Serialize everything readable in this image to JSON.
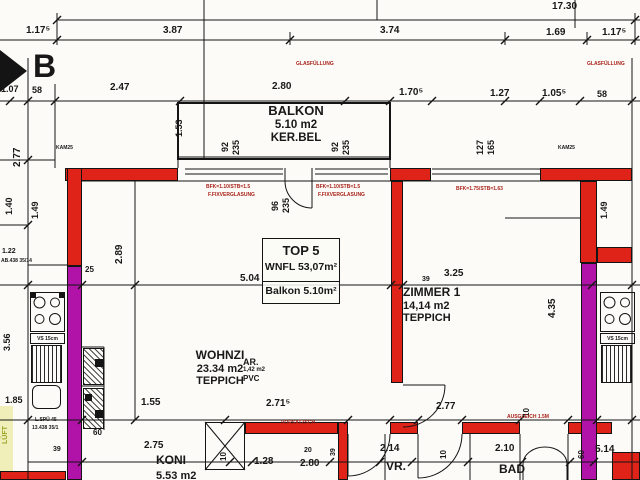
{
  "colors": {
    "wall_load_bearing": "#df2318",
    "wall_party": "#b112a7",
    "linework": "#141414",
    "note_red": "#a8211a",
    "highlight": "#e6e588",
    "paper": "#fcfbf7"
  },
  "section_marker": {
    "label": "B"
  },
  "unit_box": {
    "line1": "TOP 5",
    "line2": "WNFL 53,07m²",
    "line3": "Balkon 5.10m²"
  },
  "rooms": {
    "balkon": {
      "name": "BALKON",
      "area": "5.10 m2",
      "floor": "KER.BEL"
    },
    "wohnzimmer": {
      "name": "WOHNZI",
      "area": "23.34 m2",
      "floor": "TEPPICH"
    },
    "zimmer1": {
      "name": "ZIMMER 1",
      "area": "14,14 m2",
      "floor": "TEPPICH"
    },
    "abstellraum": {
      "name": "AR.",
      "area": "1,42 m2",
      "floor": "PVC"
    },
    "kochnische": {
      "name": "KONI",
      "area": "5.53 m2"
    },
    "vorraum": {
      "name": "VR."
    },
    "bad": {
      "name": "BAD"
    }
  },
  "fixtures": {
    "vs_label": "VS 15cm"
  },
  "annotations": [
    {
      "t": "17.30",
      "x": 552,
      "y": 2,
      "s": 10
    },
    {
      "t": "1.17⁵",
      "x": 26,
      "y": 26,
      "s": 10
    },
    {
      "t": "3.87",
      "x": 163,
      "y": 26,
      "s": 10
    },
    {
      "t": "3.74",
      "x": 380,
      "y": 26,
      "s": 10
    },
    {
      "t": "1.69",
      "x": 546,
      "y": 28,
      "s": 10
    },
    {
      "t": "1.17⁵",
      "x": 602,
      "y": 28,
      "s": 10
    },
    {
      "t": "1.07",
      "x": 1,
      "y": 85,
      "s": 9
    },
    {
      "t": "58",
      "x": 32,
      "y": 86,
      "s": 9
    },
    {
      "t": "2.47",
      "x": 110,
      "y": 83,
      "s": 10
    },
    {
      "t": "2.80",
      "x": 272,
      "y": 82,
      "s": 10
    },
    {
      "t": "1.70⁵",
      "x": 399,
      "y": 88,
      "s": 10
    },
    {
      "t": "1.27",
      "x": 490,
      "y": 89,
      "s": 10
    },
    {
      "t": "1.05⁵",
      "x": 542,
      "y": 89,
      "s": 10
    },
    {
      "t": "58",
      "x": 597,
      "y": 90,
      "s": 9
    },
    {
      "t": "GLASFÜLLUNG",
      "x": 296,
      "y": 62,
      "s": 5,
      "c": "red"
    },
    {
      "t": "GLASFÜLLUNG",
      "x": 587,
      "y": 62,
      "s": 5,
      "c": "red"
    },
    {
      "t": "KAM25",
      "x": 56,
      "y": 146,
      "s": 5
    },
    {
      "t": "KAM25",
      "x": 558,
      "y": 146,
      "s": 5
    },
    {
      "t": "BFK=1.10/STB=1.5",
      "x": 206,
      "y": 185,
      "s": 5,
      "c": "red"
    },
    {
      "t": "F.FIXVERGLASUNG",
      "x": 208,
      "y": 193,
      "s": 5,
      "c": "red"
    },
    {
      "t": "BFK=1.10/STB=1.5",
      "x": 316,
      "y": 185,
      "s": 5,
      "c": "red"
    },
    {
      "t": "F.FIXVERGLASUNG",
      "x": 318,
      "y": 193,
      "s": 5,
      "c": "red"
    },
    {
      "t": "BFK=1.75/STB=1.63",
      "x": 456,
      "y": 187,
      "s": 5,
      "c": "red"
    },
    {
      "t": "92",
      "x": 221,
      "y": 152,
      "r": 1,
      "s": 9
    },
    {
      "t": "235",
      "x": 232,
      "y": 155,
      "r": 1,
      "s": 9
    },
    {
      "t": "92",
      "x": 331,
      "y": 152,
      "r": 1,
      "s": 9
    },
    {
      "t": "235",
      "x": 342,
      "y": 155,
      "r": 1,
      "s": 9
    },
    {
      "t": "127",
      "x": 476,
      "y": 155,
      "r": 1,
      "s": 9
    },
    {
      "t": "165",
      "x": 487,
      "y": 155,
      "r": 1,
      "s": 9
    },
    {
      "t": "96",
      "x": 271,
      "y": 211,
      "r": 1,
      "s": 9
    },
    {
      "t": "235",
      "x": 282,
      "y": 213,
      "r": 1,
      "s": 9
    },
    {
      "t": "2.77",
      "x": 13,
      "y": 167,
      "r": 1,
      "s": 10
    },
    {
      "t": "1.40",
      "x": 5,
      "y": 215,
      "r": 1,
      "s": 9
    },
    {
      "t": "1.49",
      "x": 31,
      "y": 219,
      "r": 1,
      "s": 9
    },
    {
      "t": "1.53",
      "x": 175,
      "y": 137,
      "r": 1,
      "s": 9
    },
    {
      "t": "2.89",
      "x": 115,
      "y": 264,
      "r": 1,
      "s": 10
    },
    {
      "t": "25",
      "x": 85,
      "y": 266,
      "s": 8
    },
    {
      "t": "3.56",
      "x": 3,
      "y": 351,
      "r": 1,
      "s": 9
    },
    {
      "t": "1.49",
      "x": 600,
      "y": 219,
      "r": 1,
      "s": 9
    },
    {
      "t": "4.35",
      "x": 548,
      "y": 318,
      "r": 1,
      "s": 10
    },
    {
      "t": "5.04",
      "x": 240,
      "y": 274,
      "s": 10
    },
    {
      "t": "3.25",
      "x": 444,
      "y": 269,
      "s": 10
    },
    {
      "t": "39",
      "x": 422,
      "y": 276,
      "s": 7
    },
    {
      "t": "1.85",
      "x": 5,
      "y": 396,
      "s": 9
    },
    {
      "t": "1.55",
      "x": 141,
      "y": 398,
      "s": 10
    },
    {
      "t": "2.71⁵",
      "x": 266,
      "y": 399,
      "s": 10
    },
    {
      "t": "2.77",
      "x": 436,
      "y": 402,
      "s": 10
    },
    {
      "t": "10",
      "x": 523,
      "y": 417,
      "r": 1,
      "s": 8
    },
    {
      "t": "AUSGLEICH 1.5M",
      "x": 507,
      "y": 415,
      "s": 5,
      "c": "red"
    },
    {
      "t": "VORSATZSCH",
      "x": 281,
      "y": 421,
      "s": 5,
      "c": "red"
    },
    {
      "t": "60",
      "x": 93,
      "y": 429,
      "s": 8
    },
    {
      "t": "L.SPÜ 45",
      "x": 35,
      "y": 418,
      "s": 5
    },
    {
      "t": "13.438 35/1",
      "x": 32,
      "y": 426,
      "s": 5
    },
    {
      "t": "AB.438 35/14",
      "x": 1,
      "y": 259,
      "s": 5
    },
    {
      "t": "1.22",
      "x": 2,
      "y": 248,
      "s": 7
    },
    {
      "t": "2.75",
      "x": 144,
      "y": 441,
      "s": 10
    },
    {
      "t": "10",
      "x": 220,
      "y": 461,
      "r": 1,
      "s": 8
    },
    {
      "t": "1.28",
      "x": 254,
      "y": 457,
      "s": 10
    },
    {
      "t": "2.80",
      "x": 300,
      "y": 459,
      "s": 10
    },
    {
      "t": "20",
      "x": 304,
      "y": 447,
      "s": 7
    },
    {
      "t": "39",
      "x": 330,
      "y": 456,
      "r": 1,
      "s": 7
    },
    {
      "t": "2.14",
      "x": 380,
      "y": 444,
      "s": 10
    },
    {
      "t": "10",
      "x": 440,
      "y": 459,
      "r": 1,
      "s": 8
    },
    {
      "t": "2.10",
      "x": 495,
      "y": 444,
      "s": 10
    },
    {
      "t": "60",
      "x": 578,
      "y": 459,
      "r": 1,
      "s": 8
    },
    {
      "t": "5.14",
      "x": 595,
      "y": 445,
      "s": 10
    },
    {
      "t": "39",
      "x": 53,
      "y": 446,
      "s": 7
    },
    {
      "t": "LÜFT",
      "x": 2,
      "y": 444,
      "r": 1,
      "s": 7,
      "c": "green"
    }
  ]
}
